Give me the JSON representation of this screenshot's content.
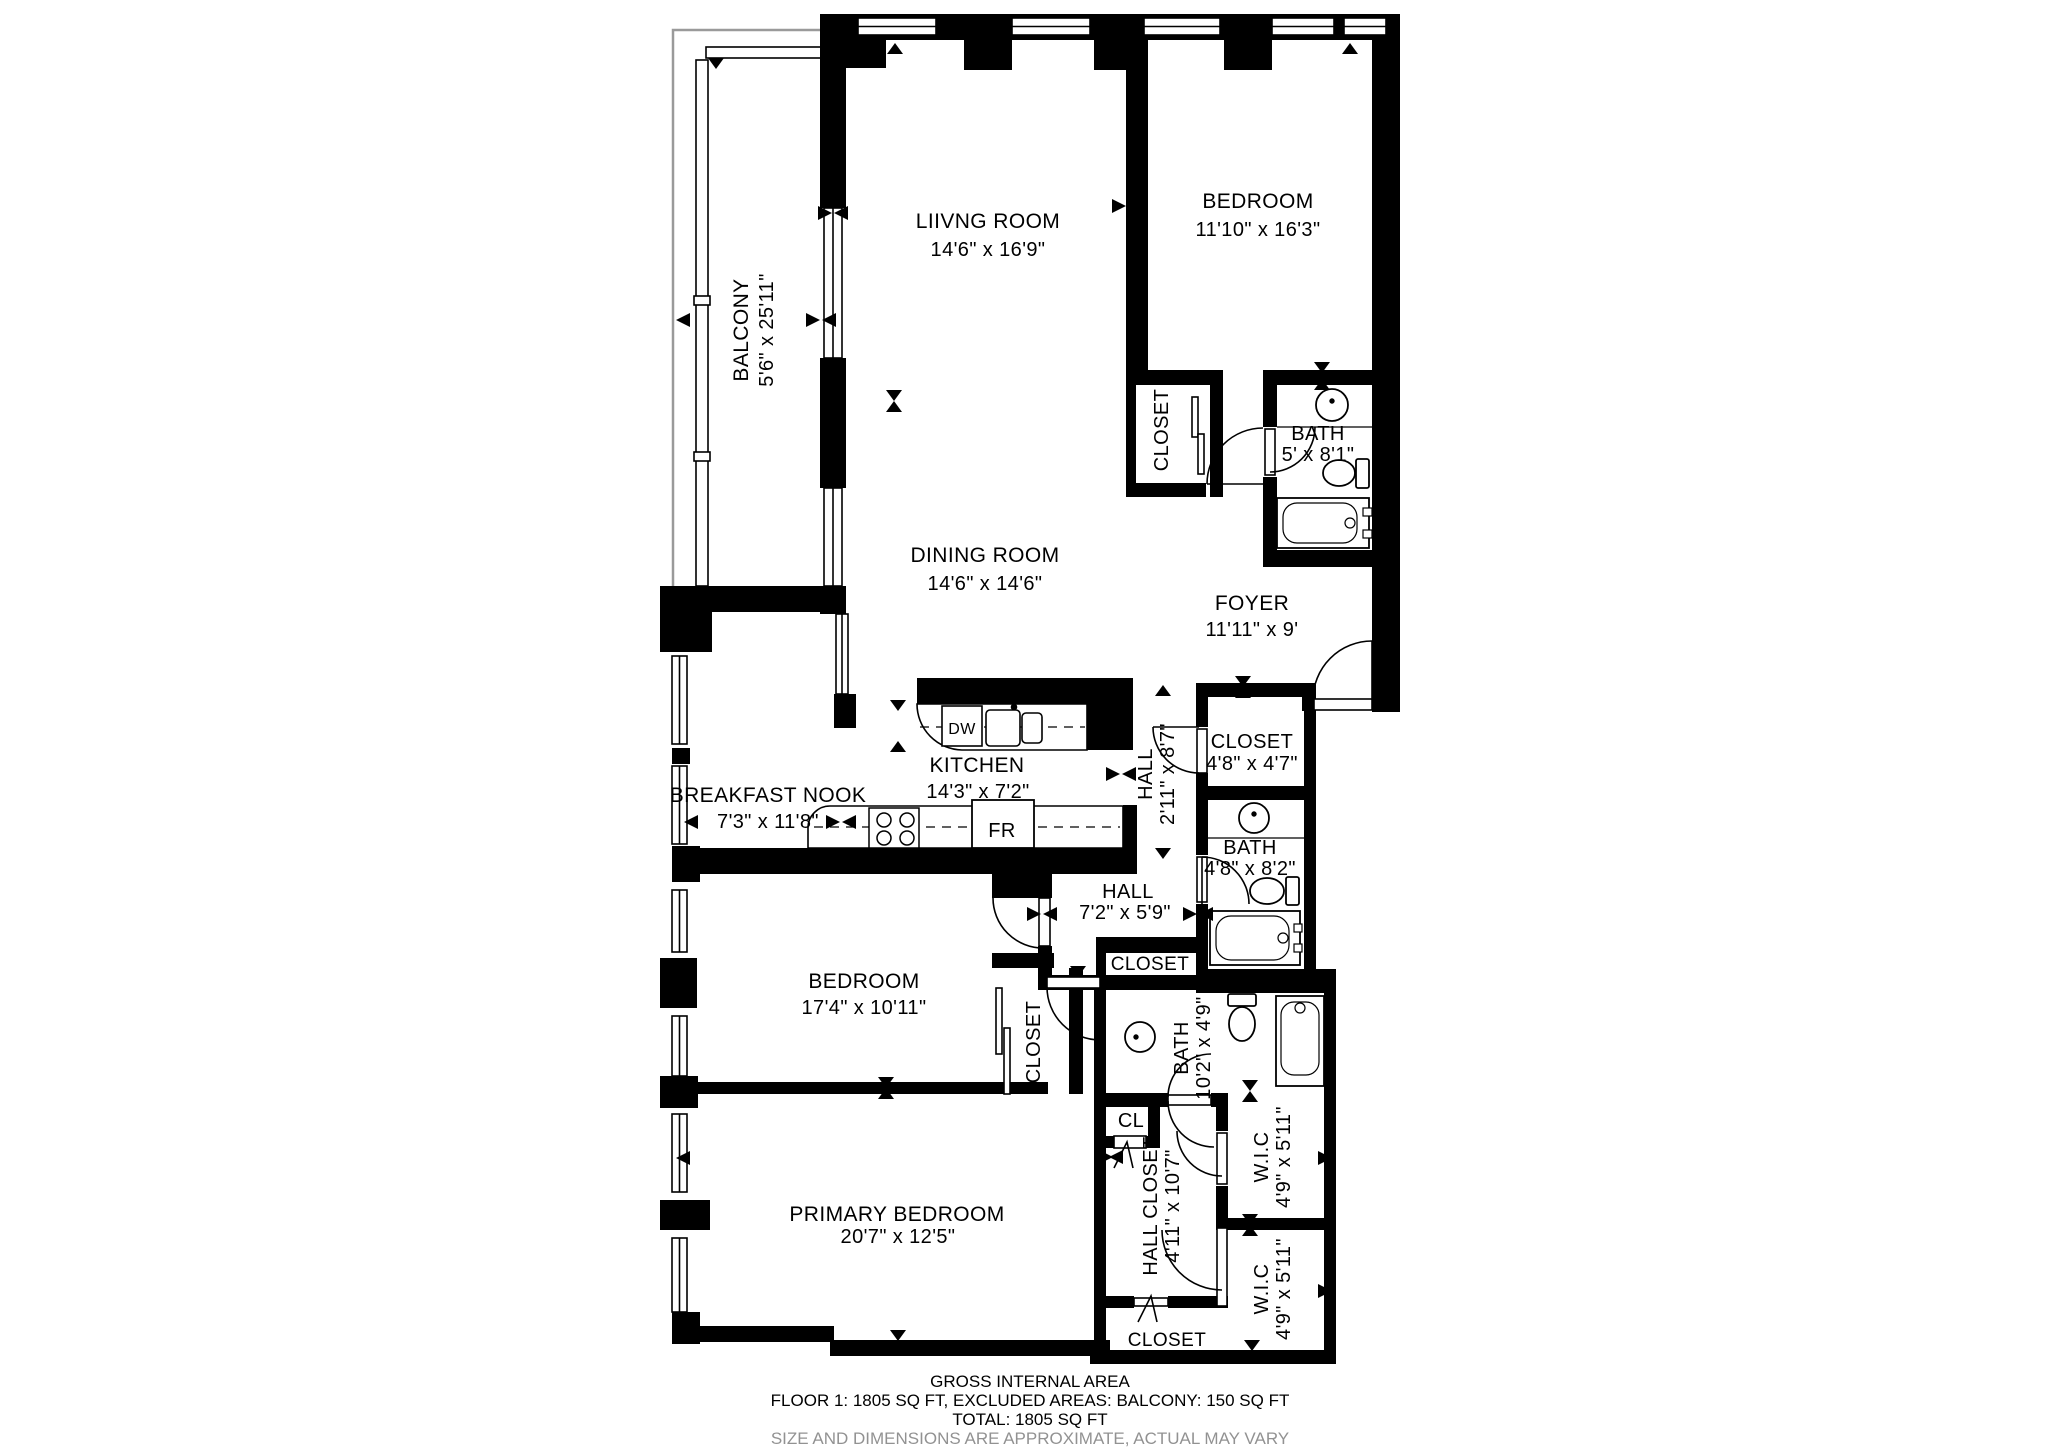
{
  "rooms": {
    "balcony": {
      "name": "BALCONY",
      "dims": "5'6\" x 25'11\""
    },
    "living_room": {
      "name": "LIIVNG ROOM",
      "dims": "14'6\" x 16'9\""
    },
    "bedroom_top": {
      "name": "BEDROOM",
      "dims": "11'10\" x 16'3\""
    },
    "bedroom_top_closet": {
      "name": "CLOSET"
    },
    "bath_top": {
      "name": "BATH",
      "dims": "5' x 8'1\""
    },
    "dining_room": {
      "name": "DINING ROOM",
      "dims": "14'6\" x 14'6\""
    },
    "foyer": {
      "name": "FOYER",
      "dims": "11'11\" x 9'"
    },
    "breakfast_nook": {
      "name": "BREAKFAST NOOK",
      "dims": "7'3\" x 11'8\""
    },
    "kitchen": {
      "name": "KITCHEN",
      "dims": "14'3\" x 7'2\""
    },
    "hall_narrow": {
      "name": "HALL",
      "dims": "2'11\" x 8'7\""
    },
    "closet_foyer": {
      "name": "CLOSET",
      "dims": "4'8\" x 4'7\""
    },
    "bath_mid": {
      "name": "BATH",
      "dims": "4'8\" x 8'2\""
    },
    "hall_mid": {
      "name": "HALL",
      "dims": "7'2\" x 5'9\""
    },
    "bedroom_mid": {
      "name": "BEDROOM",
      "dims": "17'4\" x 10'11\""
    },
    "bedroom_mid_closet": {
      "name": "CLOSET"
    },
    "closet_shallow": {
      "name": "CLOSET"
    },
    "bath_lower": {
      "name": "BATH",
      "dims": "10'2\" x 4'9\""
    },
    "cl": {
      "name": "CL"
    },
    "hall_closet": {
      "name": "HALL CLOSET",
      "dims": "4'11\" x 10'7\""
    },
    "wic_top": {
      "name": "W.I.C",
      "dims": "4'9\" x 5'11\""
    },
    "wic_bottom": {
      "name": "W.I.C",
      "dims": "4'9\" x 5'11\""
    },
    "primary_bedroom": {
      "name": "PRIMARY BEDROOM",
      "dims": "20'7\" x 12'5\""
    },
    "closet_bottom": {
      "name": "CLOSET"
    }
  },
  "appliances": {
    "dishwasher": "DW",
    "fridge": "FR"
  },
  "footer": {
    "line1": "GROSS INTERNAL AREA",
    "line2": "FLOOR 1: 1805 SQ FT, EXCLUDED AREAS: BALCONY: 150 SQ FT",
    "line3": "TOTAL: 1805 SQ FT",
    "disclaimer": "SIZE AND DIMENSIONS ARE APPROXIMATE, ACTUAL MAY VARY"
  },
  "colors": {
    "wall": "#000000",
    "background": "#ffffff",
    "disclaimer": "#929292",
    "outline": "#9a9a9a"
  }
}
